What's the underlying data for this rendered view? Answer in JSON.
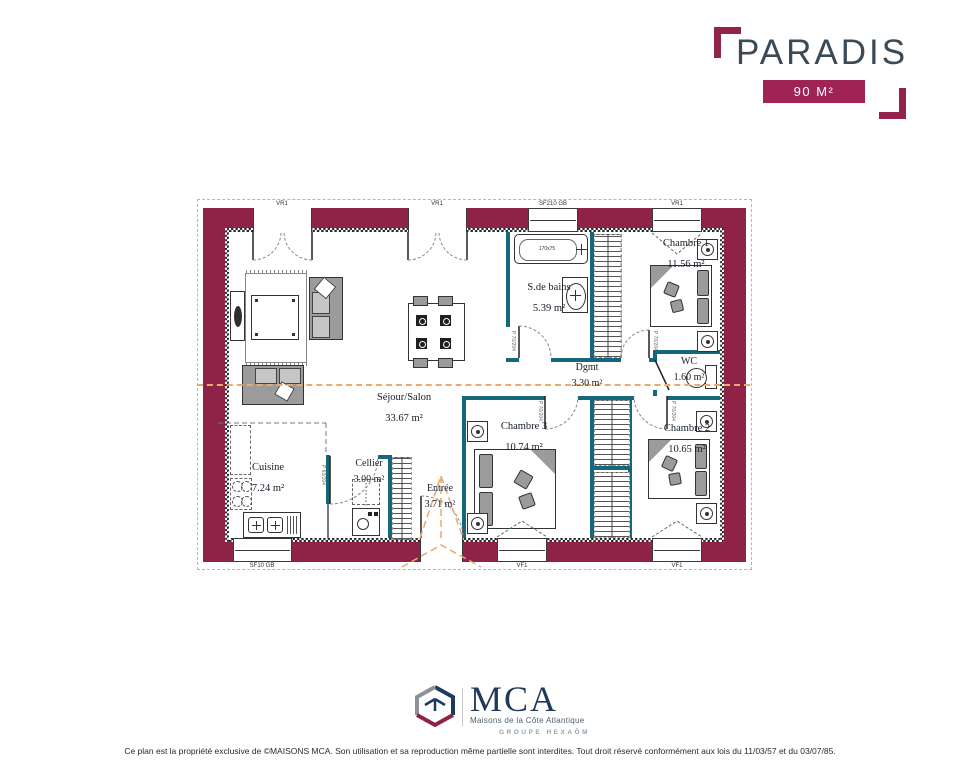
{
  "header": {
    "title": "PARADIS",
    "badge": "90 M²"
  },
  "plan": {
    "rooms": {
      "sejour": {
        "label": "Séjour/Salon",
        "area": "33.67 m²"
      },
      "cuisine": {
        "label": "Cuisine",
        "area": "7.24 m²"
      },
      "cellier": {
        "label": "Cellier",
        "area": "3.00 m²"
      },
      "entree": {
        "label": "Entrée",
        "area": "3.71 m²"
      },
      "sdb": {
        "label": "S.de bains",
        "area": "5.39 m²"
      },
      "dgmt": {
        "label": "Dgmt",
        "area": "3.30 m²"
      },
      "wc": {
        "label": "WC",
        "area": "1.60 m²"
      },
      "ch1": {
        "label": "Chambre 1",
        "area": "11.56 m²"
      },
      "ch2": {
        "label": "Chambre 2",
        "area": "10.65 m²"
      },
      "ch3": {
        "label": "Chambre 3",
        "area": "10.74 m²"
      }
    },
    "openings": {
      "vr1": "VR1",
      "sf210": "SF210 GB",
      "sf10": "SF10 GB",
      "vf1": "VF1"
    },
    "doors": {
      "p70": "P 70/204",
      "p63": "P 63/204"
    },
    "fixtures": {
      "bathtub": "170x75"
    },
    "colors": {
      "exterior_wall": "#8e2347",
      "interior_wall": "#15687a",
      "section_line": "#eaaa6e",
      "accent": "#9f2355"
    }
  },
  "footer": {
    "logo_text": "MCA",
    "logo_subtitle": "Maisons de la Côte Atlantique",
    "logo_group": "GROUPE HEXAŌM",
    "disclaimer": "Ce plan est la propriété exclusive de ©MAISONS MCA. Son utilisation et sa reproduction même partielle sont interdites. Tout droit réservé conformément aux lois du 11/03/57 et du 03/07/85."
  }
}
